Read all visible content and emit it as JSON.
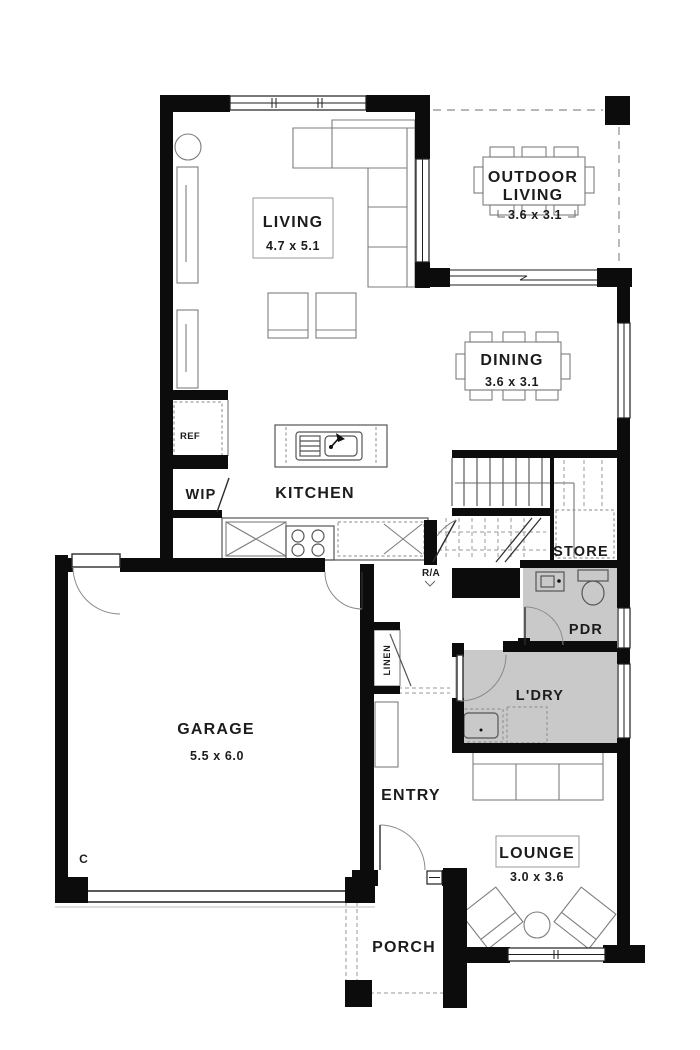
{
  "document_type": "house floor plan",
  "colors": {
    "wall": "#0c0c0c",
    "shaded_floor": "#c9c9c9",
    "background": "#ffffff"
  },
  "labels": {
    "living": "LIVING",
    "living_dims": "4.7 x 5.1",
    "outdoor_line1": "OUTDOOR",
    "outdoor_line2": "LIVING",
    "outdoor_dims": "3.6 x 3.1",
    "dining": "DINING",
    "dining_dims": "3.6 x 3.1",
    "kitchen": "KITCHEN",
    "ref": "REF",
    "wip": "WIP",
    "store": "STORE",
    "ra": "R/A",
    "pdr": "PDR",
    "ldry": "L'DRY",
    "linen": "LINEN",
    "garage": "GARAGE",
    "garage_dims": "5.5 x 6.0",
    "entry": "ENTRY",
    "lounge": "LOUNGE",
    "lounge_dims": "3.0 x 3.6",
    "porch": "PORCH",
    "c_marker": "C"
  },
  "rooms": [
    {
      "name": "LIVING",
      "dimensions": "4.7 x 5.1"
    },
    {
      "name": "OUTDOOR LIVING",
      "dimensions": "3.6 x 3.1"
    },
    {
      "name": "DINING",
      "dimensions": "3.6 x 3.1"
    },
    {
      "name": "KITCHEN"
    },
    {
      "name": "WIP"
    },
    {
      "name": "REF"
    },
    {
      "name": "STORE"
    },
    {
      "name": "R/A"
    },
    {
      "name": "PDR"
    },
    {
      "name": "L'DRY"
    },
    {
      "name": "LINEN"
    },
    {
      "name": "GARAGE",
      "dimensions": "5.5 x 6.0"
    },
    {
      "name": "ENTRY"
    },
    {
      "name": "LOUNGE",
      "dimensions": "3.0 x 3.6"
    },
    {
      "name": "PORCH"
    }
  ]
}
